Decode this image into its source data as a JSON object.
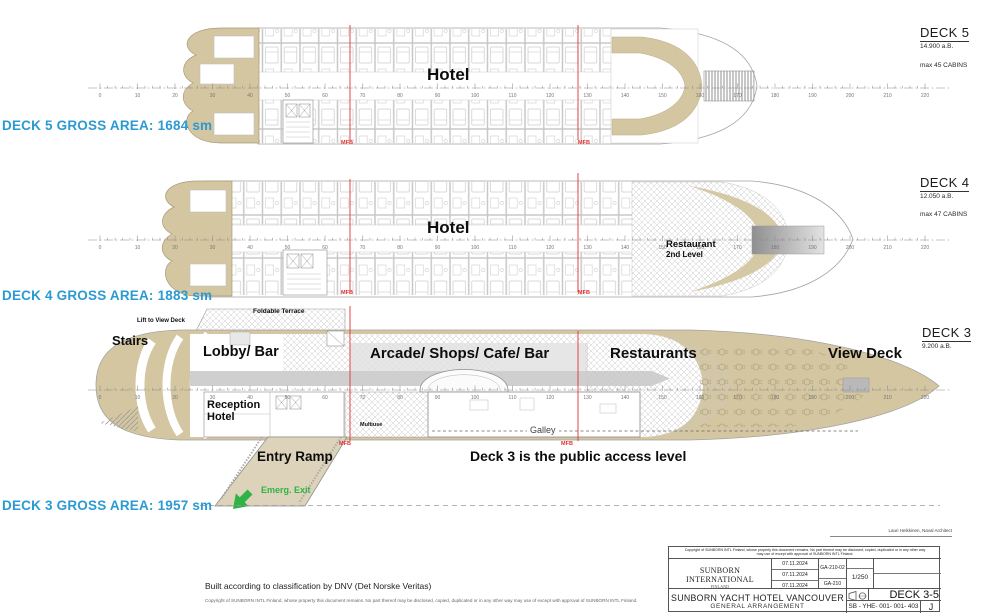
{
  "colors": {
    "accent_blue": "#2b9ad3",
    "hull_tan": "#d3c6a1",
    "mfb_red": "#e23232",
    "emerg_green": "#2fb347"
  },
  "ruler": {
    "start": 0,
    "end": 220,
    "step": 10,
    "minor_step": 2
  },
  "mfb_label": "MFB",
  "decks": [
    {
      "name": "deck-5",
      "title": "DECK 5",
      "elevation": "14.900 a.B.",
      "cabins": "max 45 CABINS",
      "gross_area": "DECK 5 GROSS AREA: 1684 sm",
      "area_label": "Hotel"
    },
    {
      "name": "deck-4",
      "title": "DECK 4",
      "elevation": "12.050 a.B.",
      "cabins": "max 47 CABINS",
      "gross_area": "DECK 4 GROSS AREA: 1883 sm",
      "area_label": "Hotel",
      "restaurant_line1": "Restaurant",
      "restaurant_line2": "2nd Level"
    },
    {
      "name": "deck-3",
      "title": "DECK 3",
      "elevation": "9.200 a.B.",
      "gross_area": "DECK 3 GROSS AREA: 1957 sm",
      "labels": {
        "stairs": "Stairs",
        "lift": "Lift to View Deck",
        "foldable_terrace": "Foldable Terrace",
        "lobby": "Lobby/ Bar",
        "reception_line1": "Reception",
        "reception_line2": "Hotel",
        "arcade": "Arcade/ Shops/ Cafe/ Bar",
        "restaurants": "Restaurants",
        "view_deck": "View Deck",
        "multiuse": "Multiuse",
        "galley": "Galley",
        "entry_ramp": "Entry Ramp",
        "emerg_exit": "Emerg. Exit",
        "note": "Deck 3 is the public access level"
      }
    }
  ],
  "footer": {
    "classification": "Built according to classification by DNV (Det Norske Veritas)",
    "copyright": "Copyright of SUNBORN INTL Finland, whose property this document remains. No part thereof may be disclosed, copied, duplicated or in any other way may use of except with approval of SUNBORN INTL Finland."
  },
  "title_block": {
    "architect": "Lauri Heikkinen, Naval Architect",
    "copyright": "Copyright of SUNBORN INTL Finland, whose property this document remains. No part thereof may be disclosed, copied, duplicated or in any other way may use of except with approval of SUNBORN INTL Finland.",
    "company": "SUNBORN INTERNATIONAL",
    "company_sub": "FINLAND",
    "date1": "07.11.2024",
    "date2": "07.11.2024",
    "date3": "07.11.2024",
    "doc1": "GA-210-02",
    "doc2": "GA-210",
    "scale": "1/250",
    "sheet": "DECK 3-5",
    "project": "SUNBORN YACHT HOTEL VANCOUVER",
    "drawing": "GENERAL ARRANGEMENT",
    "number": "SB - YHE- 001- 001- 403",
    "revision": "J"
  }
}
